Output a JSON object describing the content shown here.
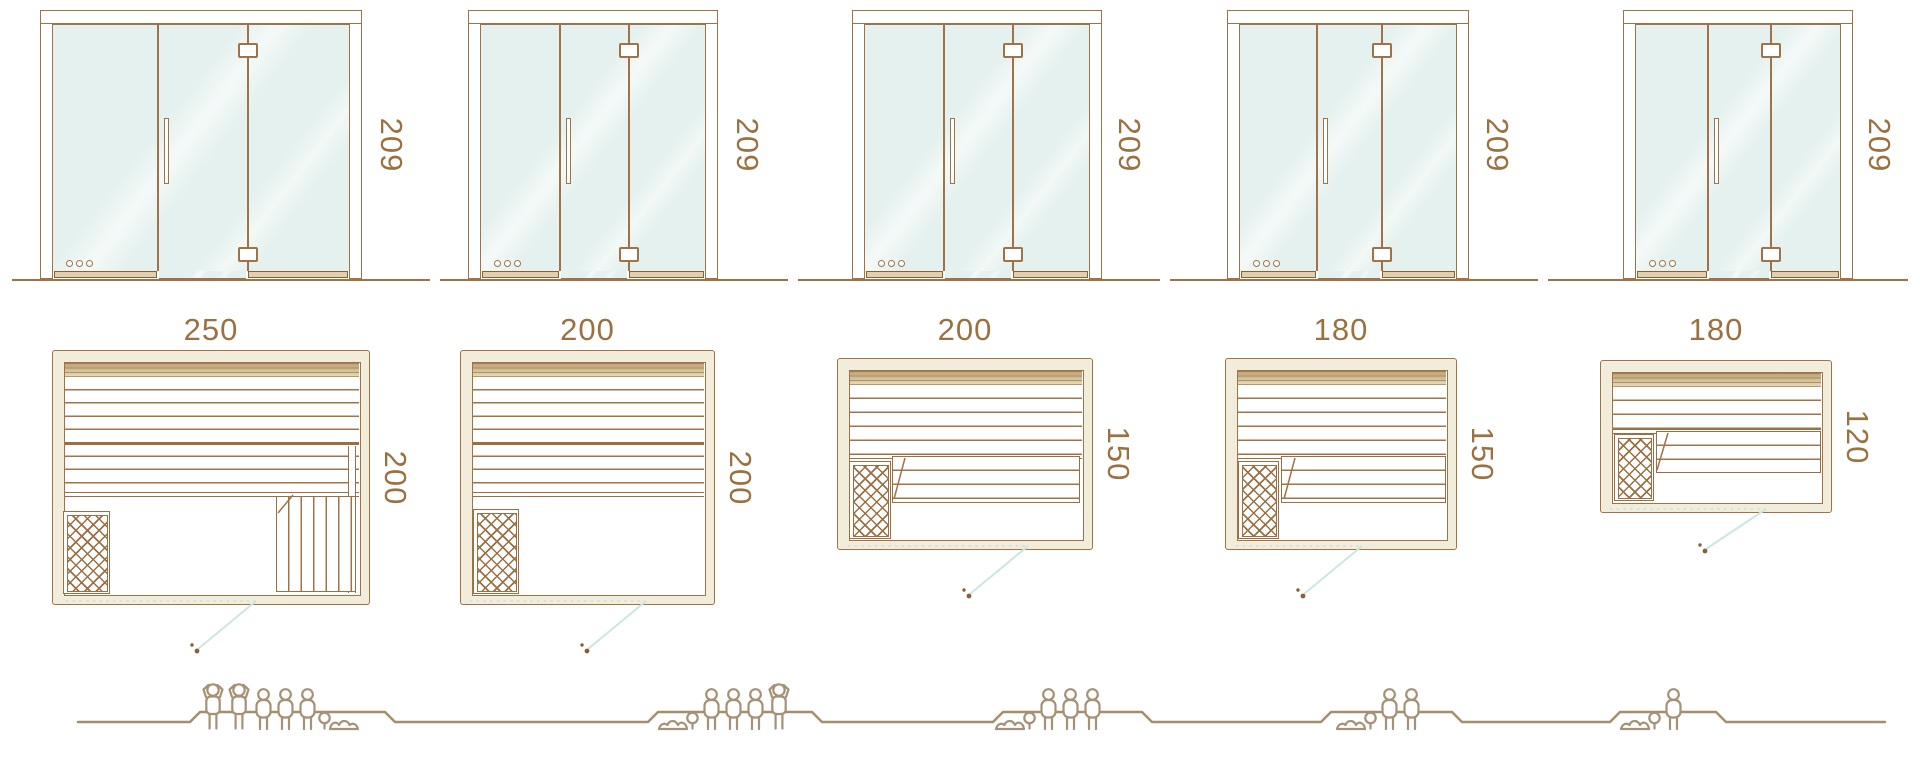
{
  "diagram": "sauna-model-size-comparison",
  "models": [
    {
      "name": "sauna-250x200",
      "height_cm": "209",
      "width_cm": "250",
      "depth_cm": "200",
      "capacity": {
        "standing": 2,
        "sitting": 3,
        "lying": 1,
        "total": 6
      }
    },
    {
      "name": "sauna-200x200",
      "height_cm": "209",
      "width_cm": "200",
      "depth_cm": "200",
      "capacity": {
        "standing": 1,
        "sitting": 3,
        "lying": 1,
        "total": 5
      }
    },
    {
      "name": "sauna-200x150",
      "height_cm": "209",
      "width_cm": "200",
      "depth_cm": "150",
      "capacity": {
        "standing": 0,
        "sitting": 3,
        "lying": 1,
        "total": 4
      }
    },
    {
      "name": "sauna-180x150",
      "height_cm": "209",
      "width_cm": "180",
      "depth_cm": "150",
      "capacity": {
        "standing": 0,
        "sitting": 2,
        "lying": 1,
        "total": 3
      }
    },
    {
      "name": "sauna-180x120",
      "height_cm": "209",
      "width_cm": "180",
      "depth_cm": "120",
      "capacity": {
        "standing": 0,
        "sitting": 1,
        "lying": 1,
        "total": 2
      }
    }
  ],
  "colors": {
    "outline_brown": "#9f7347",
    "detail_brown": "#9c6f42",
    "dimension_text": "#9c7140",
    "wall_cream": "#f2edda",
    "glass_mint": "#e4f1ee",
    "door_swing_cyan": "#cde6e1",
    "figure_outline": "#a59175",
    "ground_line": "#a38f6b"
  }
}
